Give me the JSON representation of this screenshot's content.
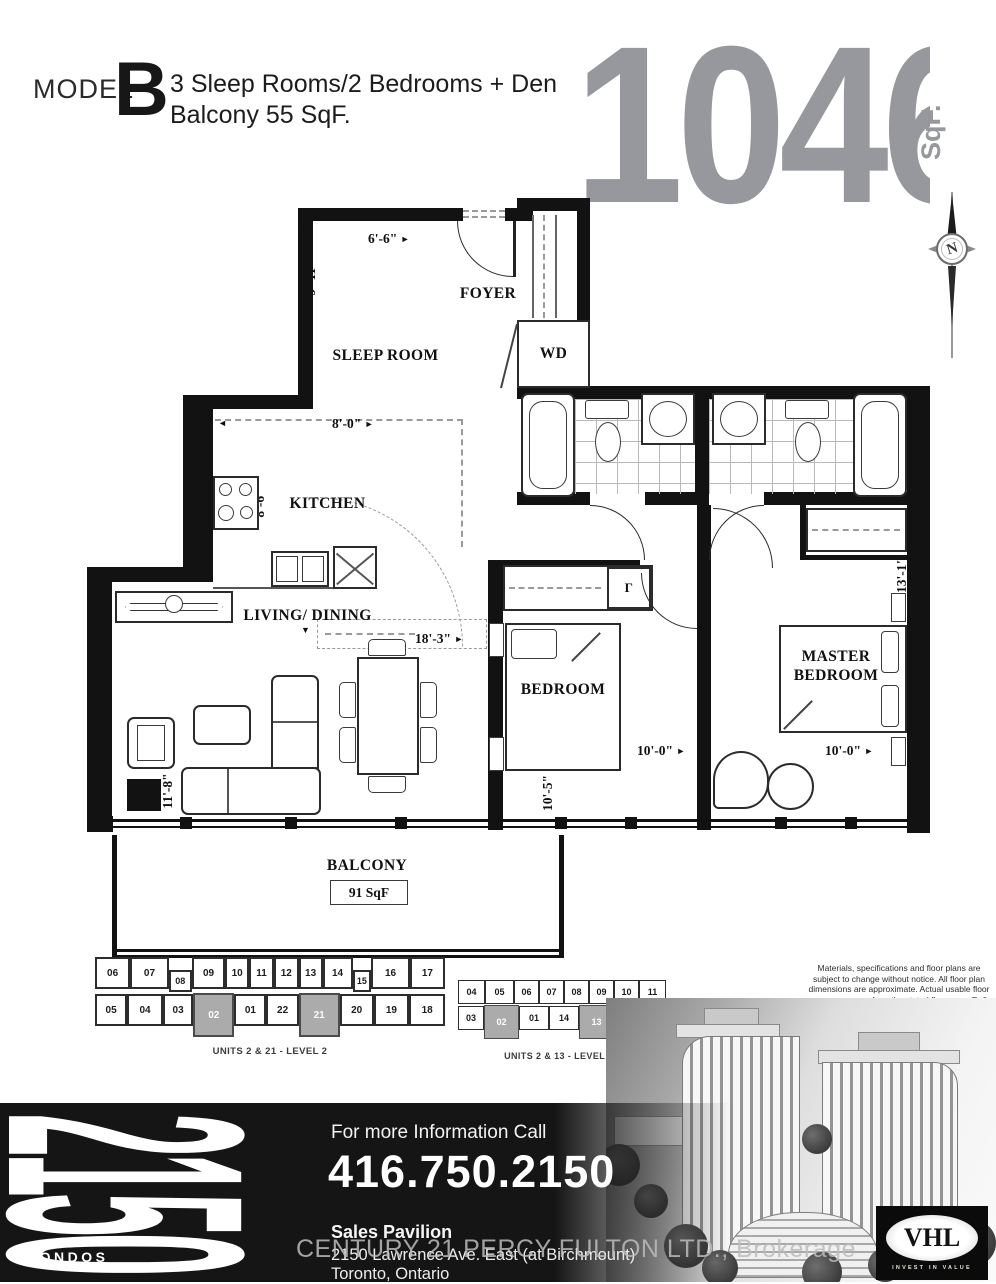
{
  "icons": {
    "arrow_left": "◄",
    "arrow_right": "►",
    "arrow_up": "▲",
    "arrow_down": "▼"
  },
  "header": {
    "model_prefix": "MODEL",
    "model_letter": "B",
    "desc_line1": "3 Sleep Rooms/2 Bedrooms + Den",
    "desc_line2": "Balcony 55 SqF.",
    "area_number": "1046",
    "area_unit": "SqF.",
    "compass_letter": "N"
  },
  "floorplan": {
    "labels": {
      "sleep_room": "SLEEP ROOM",
      "foyer": "FOYER",
      "wd": "WD",
      "kitchen": "KITCHEN",
      "living_dining": "LIVING/ DINING",
      "bedroom": "BEDROOM",
      "master_line1": "MASTER",
      "master_line2": "BEDROOM",
      "balcony": "BALCONY",
      "balcony_area": "91 SqF",
      "linen_mark": "Γ"
    },
    "dims": {
      "sleep_w": "6'-6\"",
      "sleep_h": "9'-11\"",
      "kitchen_w": "8'-0\"",
      "kitchen_h": "8'-6\"",
      "living_w": "18'-3\"",
      "living_h": "11'-8\"",
      "bedroom_w": "10'-0\"",
      "bedroom_h": "10'-5\"",
      "master_w": "10'-0\"",
      "master_h": "13'-1\""
    }
  },
  "keyplans": [
    {
      "caption": "UNITS 2 & 21 - LEVEL 2",
      "top_row": [
        "06",
        "07",
        "08",
        "09",
        "10",
        "11",
        "12",
        "13",
        "14",
        "15",
        "16",
        "17"
      ],
      "bottom_row": [
        "05",
        "04",
        "03",
        "02",
        "01",
        "22",
        "21",
        "20",
        "19",
        "18"
      ],
      "highlighted": [
        "02",
        "21"
      ],
      "small": [
        "08",
        "15"
      ]
    },
    {
      "caption": "UNITS 2 & 13 - LEVEL 3 - 8",
      "top_row": [
        "04",
        "05",
        "06",
        "07",
        "08",
        "09",
        "10",
        "11"
      ],
      "bottom_row": [
        "03",
        "02",
        "01",
        "14",
        "13",
        "12"
      ],
      "highlighted": [
        "02",
        "13"
      ],
      "small": []
    }
  ],
  "disclaimer": "Materials, specifications and floor plans are subject to change without notice.  All floor plan dimensions are approximate.  Actual usable floor space may vary from the stated floor area. E. & O.E.",
  "footer": {
    "logo_number": "2150",
    "logo_condos": "CONDOS",
    "info_call": "For more Information Call",
    "phone": "416.750.2150",
    "pavilion": "Sales Pavilion",
    "address1": "2150 Lawrence Ave. East (at Birchmount)",
    "address2": "Toronto, Ontario",
    "watermark": "CENTURY 21 PERCY FULTON LTD., Brokerage",
    "vhl": "VHL",
    "vhl_tagline": "INVEST IN VALUE"
  },
  "colors": {
    "big_number_gray": "#97989d",
    "wall_black": "#121212",
    "keyplan_highlight": "#ababab",
    "footer_black": "#151515",
    "watermark_gray": "#bcbcbc"
  }
}
